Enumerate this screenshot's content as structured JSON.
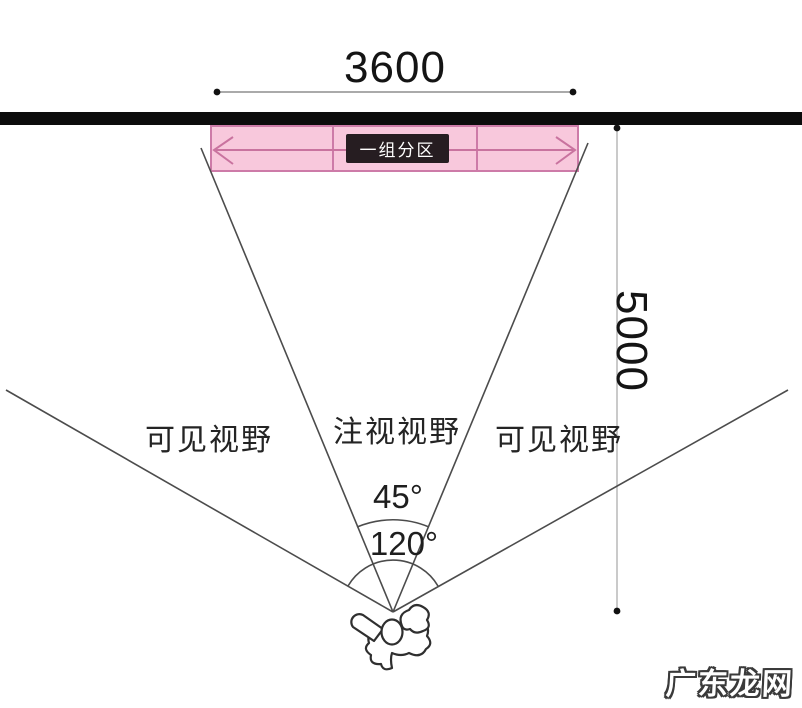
{
  "diagram": {
    "title_hint": "viewing-distance-and-angle-diagram",
    "dimensions": {
      "top_width": "3600",
      "right_height": "5000"
    },
    "screen_band": {
      "zone_label": "一组分区",
      "sections": 3,
      "fill_color": "#f8c8dc",
      "border_color": "#cd7ba8",
      "arrow_color": "#c9739f",
      "badge_color": "#261d21"
    },
    "wall_color": "#0c0c0c",
    "angles": {
      "gaze_angle": "45°",
      "visible_angle": "120°"
    },
    "field_labels": {
      "visible_left": "可见视野",
      "gaze_center": "注视视野",
      "visible_right": "可见视野"
    },
    "person_icon": "top-view-person",
    "watermark": "广东龙网"
  }
}
